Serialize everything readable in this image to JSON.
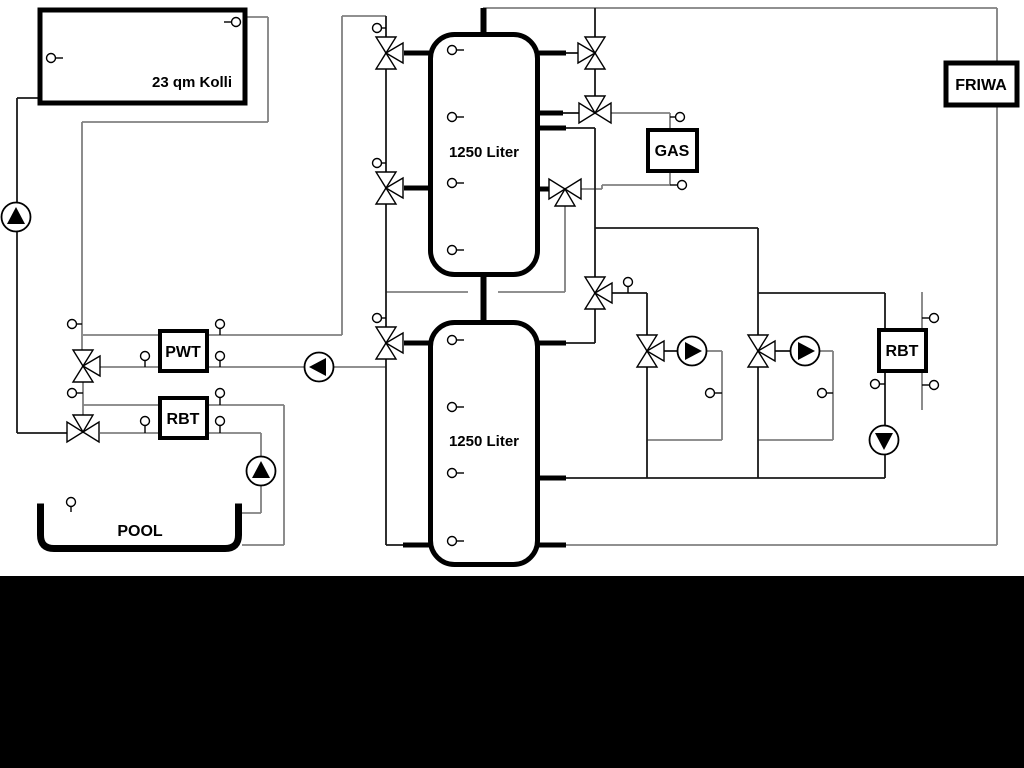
{
  "diagram": {
    "labels": {
      "collector": "23 qm Kolli",
      "tank_top": "1250 Liter",
      "tank_bottom": "1250 Liter",
      "gas": "GAS",
      "friwa": "FRIWA",
      "pwt": "PWT",
      "rbt_left": "RBT",
      "rbt_right": "RBT",
      "pool": "POOL"
    },
    "icons": {
      "pump": "pump-circle-triangle",
      "valve": "three-way-valve",
      "sensor": "temperature-sensor"
    },
    "colors": {
      "pipe_gray": "#808080",
      "pipe_black": "#1a1a1a",
      "background": "#ffffff",
      "footer": "#000000"
    }
  }
}
